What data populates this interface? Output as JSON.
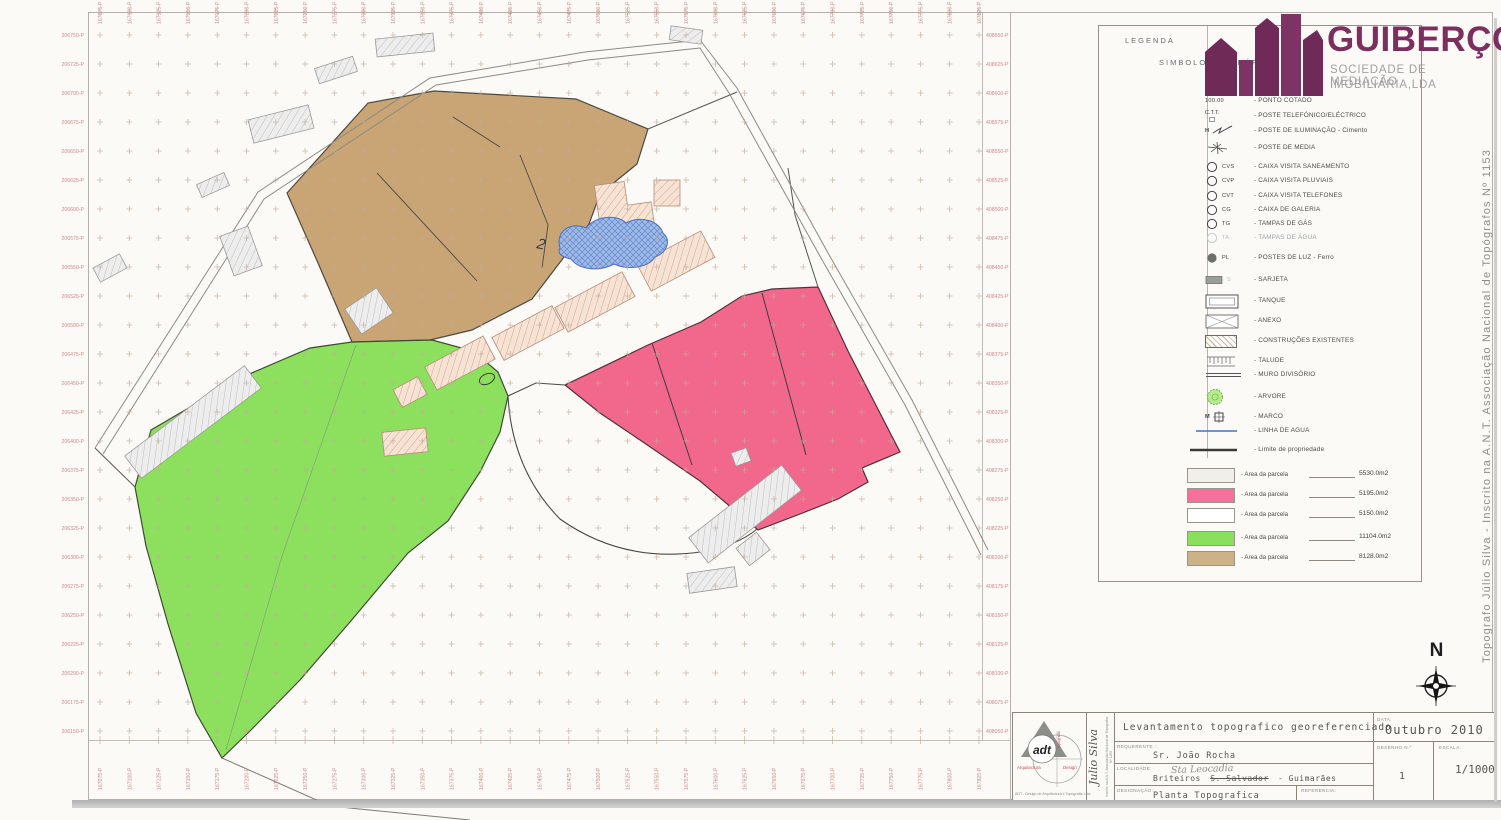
{
  "logo": {
    "brand": "GUIBERÇO",
    "sub1": "SOCIEDADE DE MEDIAÇÃO",
    "sub2": "IMOBILIÁRIA,LDA"
  },
  "legend": {
    "header1": "LEGENDA",
    "header2": "SIMBOLOGIA GRÁFICA",
    "items": [
      {
        "icon": "spot",
        "sym": "100.00",
        "label": "- PONTO COTADO"
      },
      {
        "icon": "ctt",
        "sym": "C.T.T.",
        "label": "- POSTE TELEFÓNICO/ELÉCTRICO"
      },
      {
        "icon": "ilum",
        "sym": "H",
        "label": "- POSTE DE ILUMINAÇÃO - Cimento"
      },
      {
        "icon": "media",
        "sym": "",
        "label": "- POSTE DE MEDIA"
      },
      {
        "icon": "circle",
        "sym": "CVS",
        "label": "- CAIXA VISITA SANEAMENTO"
      },
      {
        "icon": "circle",
        "sym": "CVP",
        "label": "- CAIXA VISITA PLUVIAIS"
      },
      {
        "icon": "circle",
        "sym": "CVT",
        "label": "- CAIXA VISITA TELEFONES"
      },
      {
        "icon": "circle",
        "sym": "CG",
        "label": "- CAIXA DE GALERIA"
      },
      {
        "icon": "circle",
        "sym": "TG",
        "label": "- TAMPAS DE GÁS"
      },
      {
        "icon": "circle-faint",
        "sym": "TA",
        "label": "- TAMPAS DE ÁGUA"
      },
      {
        "icon": "dot",
        "sym": "PL",
        "label": "- POSTES DE LUZ - Ferro"
      },
      {
        "icon": "sarjeta",
        "sym": "S",
        "label": "- SARJETA"
      },
      {
        "icon": "tanque",
        "sym": "",
        "label": "- TANQUE"
      },
      {
        "icon": "anexo",
        "sym": "",
        "label": "- ANEXO"
      },
      {
        "icon": "hatch",
        "sym": "",
        "label": "- CONSTRUÇÕES EXISTENTES"
      },
      {
        "icon": "talude",
        "sym": "",
        "label": "- TALUDE"
      },
      {
        "icon": "muro",
        "sym": "",
        "label": "- MURO DIVISÓRIO"
      },
      {
        "icon": "arvore",
        "sym": "",
        "label": "- ARVORE"
      },
      {
        "icon": "marco",
        "sym": "M",
        "label": "- MARCO"
      },
      {
        "icon": "agua",
        "sym": "",
        "label": "- LINHA DE AGUA"
      },
      {
        "icon": "limite",
        "sym": "",
        "label": "- Limite de propriedade"
      }
    ],
    "parcels": [
      {
        "color": "#f1efe9",
        "label": "- Area da parcela",
        "value": "5530.0m2"
      },
      {
        "color": "#f4719b",
        "label": "- Area da parcela",
        "value": "5195.0m2"
      },
      {
        "color": "#ffffff",
        "label": "- Area da parcela",
        "value": "5150.0m2"
      },
      {
        "color": "#8ae05c",
        "label": "- Area da parcela",
        "value": "11104.0m2"
      },
      {
        "color": "#cdb189",
        "label": "- Area da parcela",
        "value": "8128.0m2"
      }
    ]
  },
  "map": {
    "annotations": {
      "two": "2"
    },
    "axes": {
      "left": {
        "start": 206750,
        "step": -25,
        "count": 25,
        "suffix": "-P"
      },
      "right": {
        "start": 408650,
        "step": -25,
        "count": 25,
        "suffix": "-P"
      },
      "top": {
        "start": 167075,
        "step": 25,
        "count": 31,
        "suffix": "-P"
      },
      "bottom": {
        "start": 167075,
        "step": 25,
        "count": 31,
        "suffix": "-P"
      }
    }
  },
  "north_label": "N",
  "side_note": "Topografo Júlio Silva  -  Inscrito na A.N.T. Associação Nacional de Topógrafos Nº 1153",
  "title_block": {
    "title": "Levantamento topografico georeferenciado",
    "requerente_label": "REQUERENTE :",
    "requerente": "Sr. João Rocha",
    "localidade_label": "LOCALIDADE:",
    "localidade_pre": "Briteiros",
    "localidade_strike": "S. Salvador",
    "localidade_post": "- Guimarães",
    "localidade_hand": "Sta Leocadia",
    "designacao_label": "DESIGNAÇÃO:",
    "designacao": "Planta Topografica",
    "referencia_label": "REFERENCIA:",
    "data_label": "DATA:",
    "data": "Outubro 2010",
    "desenho_label": "DESENHO N.º",
    "desenho": "1",
    "escala_label": "ESCALA:",
    "escala": "1/1000",
    "adt_logo": "adt",
    "adt_red_left": "Arquitectura",
    "adt_red_right": "Design",
    "adt_red_vert": "Topografia",
    "adt_caption": "ADT - Design de Arquitectura e Topografia, Lda",
    "vert_name": "Julio Silva",
    "vert_small": "Inscrito na A.N.T. Associação Nacional de Topógrafos Nº 1153"
  },
  "colors": {
    "paper": "#fbfaf7",
    "tan": "#c9a475",
    "green": "#8ce05e",
    "pink": "#f2688c",
    "pond": "#9db9e8",
    "pondline": "#4a6fbe",
    "grid": "#c2ab97",
    "coord": "#cf8a8a",
    "brand": "#7b2f5f",
    "tanbld": "#f6e3d4",
    "graybld": "#ededed"
  }
}
